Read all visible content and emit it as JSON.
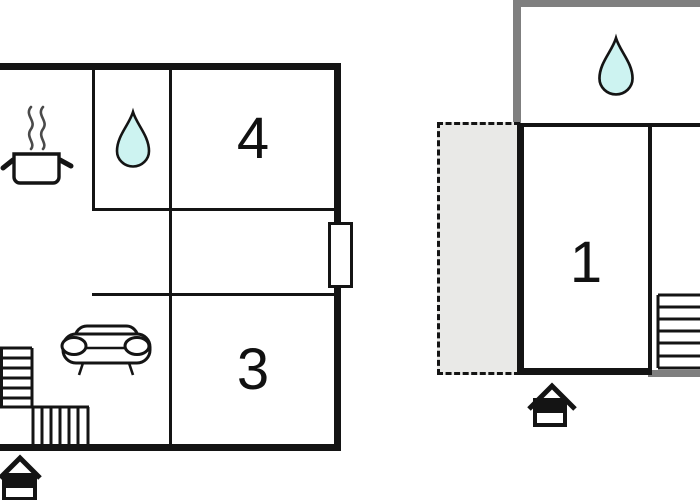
{
  "title": "holiday-home-floor-plan",
  "colors": {
    "wall_black": "#141414",
    "wall_gray": "#7f7f7f",
    "water_drop_fill": "#cdf3f1",
    "terrace_fill": "#e9e9e7",
    "steam_gray": "#4a4a4a",
    "background": "#ffffff"
  },
  "left_plan": {
    "name": "main-floor",
    "rooms": [
      {
        "id": "room-4",
        "label": "4"
      },
      {
        "id": "room-3",
        "label": "3"
      }
    ],
    "icons": [
      "steam-pot-icon",
      "water-drop-icon",
      "sofa-icon",
      "stairs-icon",
      "house-entrance-icon"
    ],
    "features": [
      "kitchen-area",
      "bathroom",
      "living-area",
      "door-on-right-wall",
      "l-shaped-stairs"
    ]
  },
  "right_plan": {
    "name": "upper-floor",
    "rooms": [
      {
        "id": "room-1",
        "label": "1"
      }
    ],
    "icons": [
      "water-drop-icon",
      "stairs-icon",
      "house-entrance-icon"
    ],
    "features": [
      "gray-floor-outline-above",
      "dashed-terrace",
      "stairs-right"
    ]
  }
}
